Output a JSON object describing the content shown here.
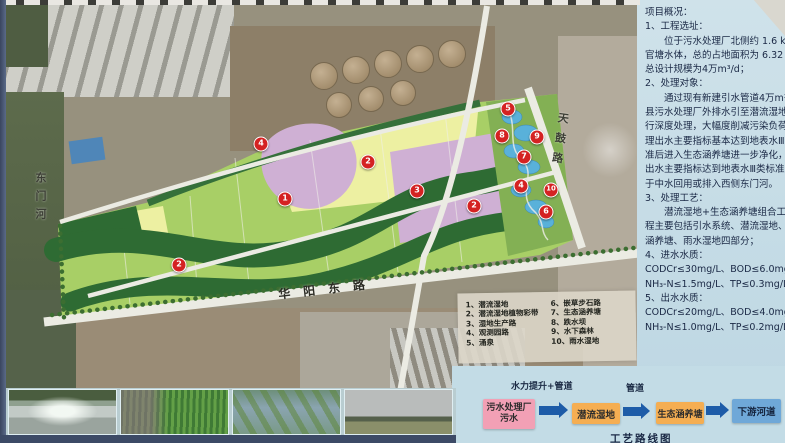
{
  "map": {
    "road_labels": {
      "left_river": "东门河",
      "bottom_road": "华阳东路",
      "right_road": "天鼓路"
    },
    "markers": [
      {
        "n": "4",
        "x": 261,
        "y": 144
      },
      {
        "n": "2",
        "x": 368,
        "y": 162
      },
      {
        "n": "1",
        "x": 285,
        "y": 199
      },
      {
        "n": "3",
        "x": 417,
        "y": 191
      },
      {
        "n": "2",
        "x": 474,
        "y": 206
      },
      {
        "n": "2",
        "x": 179,
        "y": 265
      },
      {
        "n": "5",
        "x": 508,
        "y": 109
      },
      {
        "n": "8",
        "x": 502,
        "y": 136
      },
      {
        "n": "9",
        "x": 537,
        "y": 137
      },
      {
        "n": "7",
        "x": 524,
        "y": 157
      },
      {
        "n": "4",
        "x": 521,
        "y": 186
      },
      {
        "n": "10",
        "x": 551,
        "y": 190
      },
      {
        "n": "6",
        "x": 546,
        "y": 212
      }
    ]
  },
  "legend": {
    "items_left": [
      {
        "num": "1、",
        "label": "潜流湿地"
      },
      {
        "num": "2、",
        "label": "潜流湿地植物彩带"
      },
      {
        "num": "3、",
        "label": "湿地生产路"
      },
      {
        "num": "4、",
        "label": "观测园路"
      },
      {
        "num": "5、",
        "label": "涌泉"
      }
    ],
    "items_right": [
      {
        "num": "6、",
        "label": "嵌草步石路"
      },
      {
        "num": "7、",
        "label": "生态涵养塘"
      },
      {
        "num": "8、",
        "label": "跌水坝"
      },
      {
        "num": "9、",
        "label": "水下森林"
      },
      {
        "num": "10、",
        "label": "雨水湿地"
      }
    ]
  },
  "panel": {
    "lines": [
      {
        "t": "项目概况：",
        "cls": ""
      },
      {
        "t": "1、工程选址：",
        "cls": ""
      },
      {
        "t": "位于污水处理厂北侧约 1.6 km 处",
        "cls": "ind"
      },
      {
        "t": "官塘水体，总的占地面积为 6.32 公顷",
        "cls": ""
      },
      {
        "t": "总设计规模为4万m³/d；",
        "cls": ""
      },
      {
        "t": "2、处理对象：",
        "cls": ""
      },
      {
        "t": "通过现有新建引水管道4万m³/d将",
        "cls": "ind"
      },
      {
        "t": "县污水处理厂外排水引至潜流湿地区进",
        "cls": ""
      },
      {
        "t": "行深度处理，大幅度削减污染负荷，处",
        "cls": ""
      },
      {
        "t": "理出水主要指标基本达到地表水Ⅲ类标",
        "cls": ""
      },
      {
        "t": "准后进入生态涵养塘进一步净化，处理",
        "cls": ""
      },
      {
        "t": "出水主要指标达到地表水Ⅲ类标准后用",
        "cls": ""
      },
      {
        "t": "于中水回用或排入西侧东门河。",
        "cls": ""
      },
      {
        "t": "3、处理工艺：",
        "cls": ""
      },
      {
        "t": "潜流湿地+生态涵养塘组合工艺；工",
        "cls": "ind"
      },
      {
        "t": "程主要包括引水系统、潜流湿地、生态",
        "cls": ""
      },
      {
        "t": "涵养塘、雨水湿地四部分；",
        "cls": ""
      },
      {
        "t": "4、进水水质：",
        "cls": ""
      },
      {
        "t": "CODCr≤30mg/L、BOD≤6.0mg/L、",
        "cls": ""
      },
      {
        "t": "NH₃-N≤1.5mg/L、TP≤0.3mg/L；",
        "cls": ""
      },
      {
        "t": "5、出水水质：",
        "cls": ""
      },
      {
        "t": "CODCr≤20mg/L、BOD≤4.0mg/L、",
        "cls": ""
      },
      {
        "t": "NH₃-N≤1.0mg/L、TP≤0.2mg/L。",
        "cls": ""
      }
    ]
  },
  "flow": {
    "arrow1_label": "水力提升+管道",
    "arrow2_label": "管道",
    "boxes": [
      {
        "label": "污水处理厂\n污水"
      },
      {
        "label": "潜流湿地"
      },
      {
        "label": "生态涵养塘"
      },
      {
        "label": "下游河道"
      }
    ],
    "caption": "工艺路线图"
  },
  "colors": {
    "marker_red": "#d42222",
    "plan_light_green": "#a8cf66",
    "plan_dark_green": "#2e6b33",
    "plan_yellow": "#edf0a2",
    "plan_purple": "#cfb0d4",
    "pond_blue": "#59b1da",
    "panel_blue": "#c3dce6",
    "box_pink": "#f2a0b5",
    "box_orange": "#f5ae52",
    "box_blue": "#6fa8d8",
    "arrow_blue": "#1d5ca8"
  }
}
